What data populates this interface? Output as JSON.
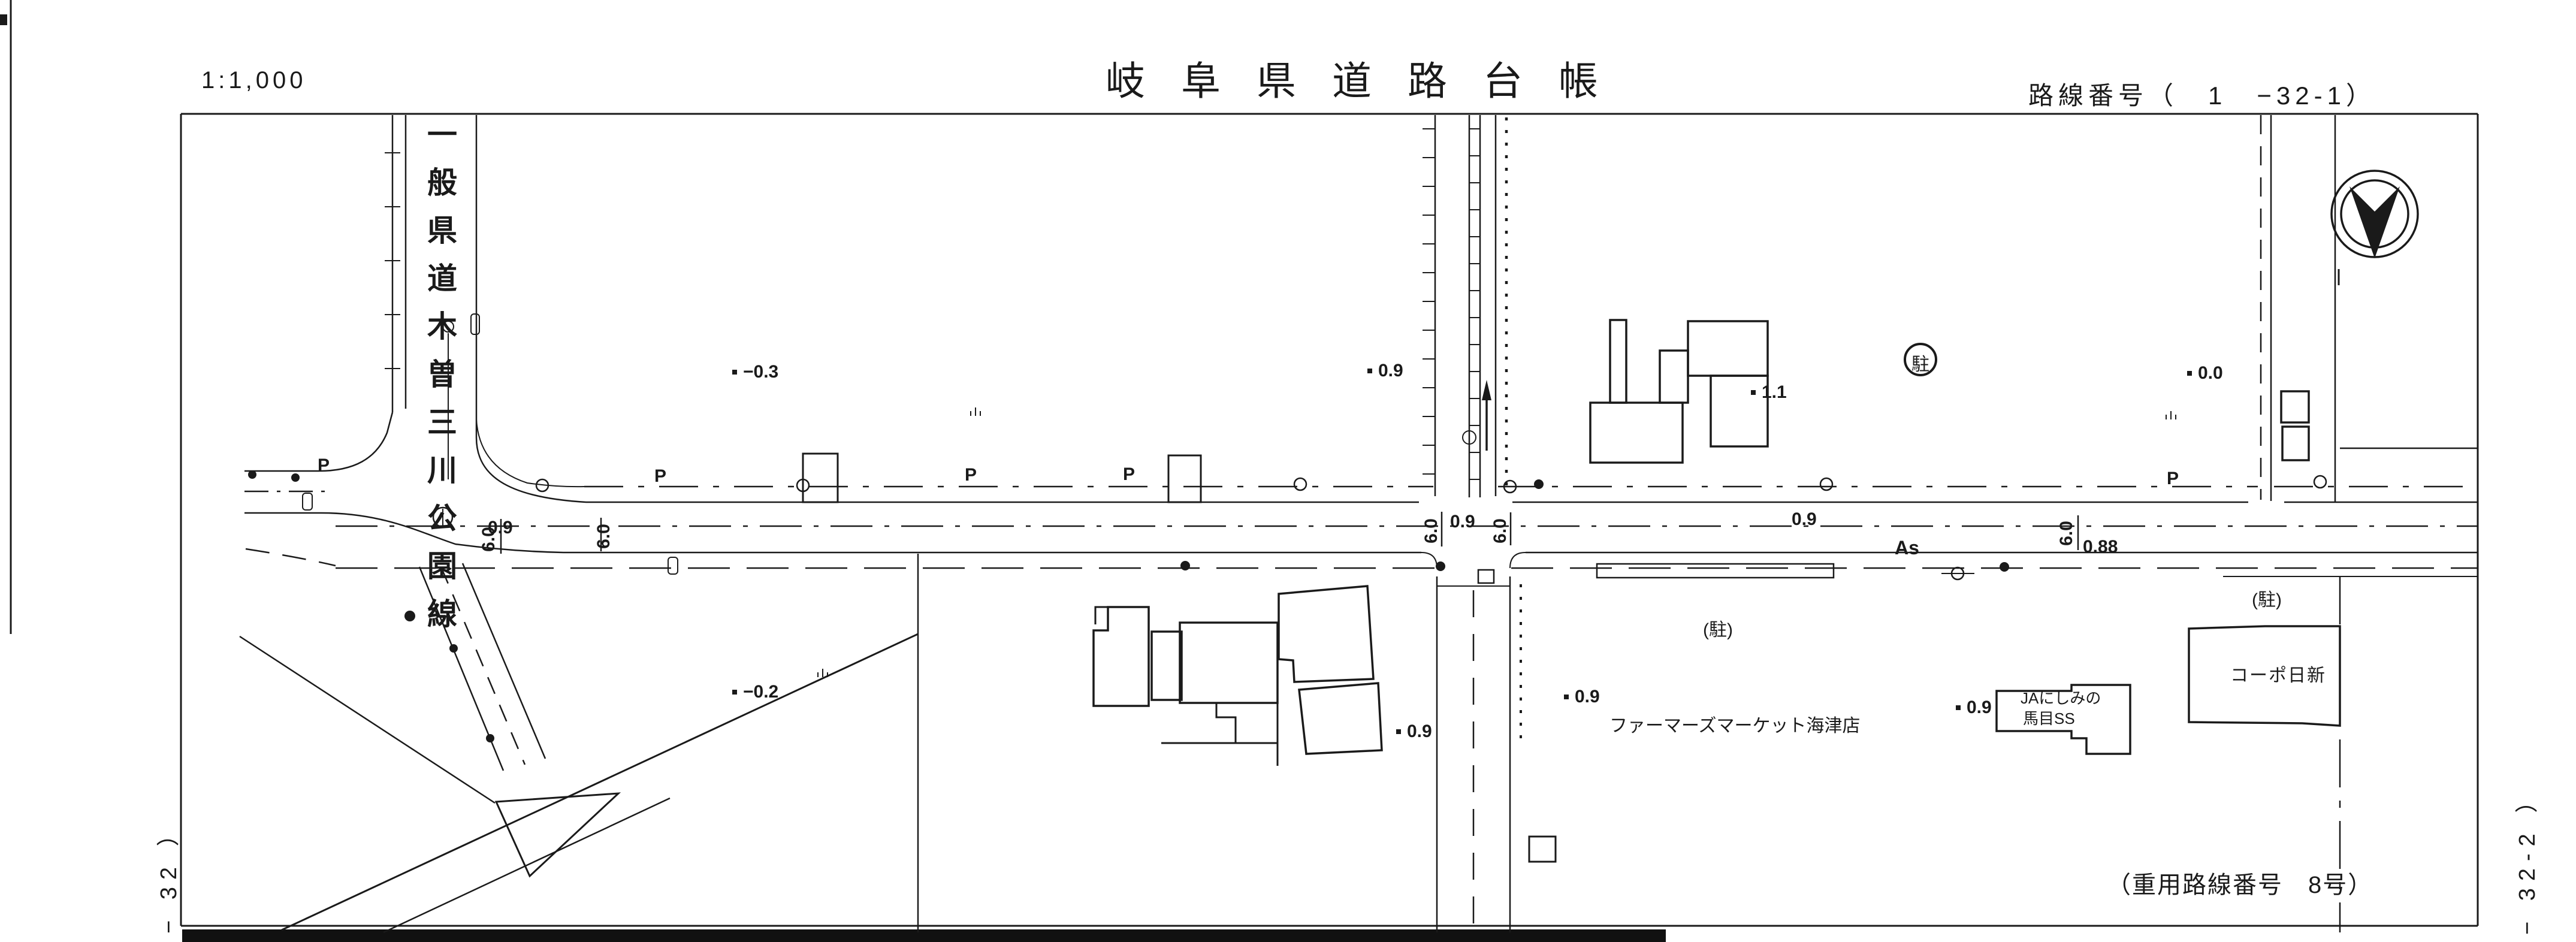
{
  "header": {
    "scale_label": "1:1,000",
    "title": "岐阜県道路台帳",
    "route_number": "路線番号（　1　−32-1）"
  },
  "sheet": {
    "ref_left": "− 32 ）",
    "ref_right": "− 32-2 ）",
    "overlap_note": "（重用路線番号　8号）"
  },
  "road": {
    "name_vertical": "一般県道木曽三川公園線",
    "surface": "As"
  },
  "buildings": {
    "farmers_market": "ファーマーズマーケット海津店",
    "ja_line1": "JAにしみの",
    "ja_line2": "馬目SS",
    "corpo_nisshin": "コーポ日新"
  },
  "annotations": {
    "spot_elevations": [
      {
        "value": "−0.3"
      },
      {
        "value": "0.9"
      },
      {
        "value": "1.1"
      },
      {
        "value": "0.0"
      },
      {
        "value": "−0.2"
      },
      {
        "value": "0.9"
      },
      {
        "value": "0.9"
      },
      {
        "value": "0.9"
      }
    ],
    "road_widths": [
      {
        "value": "6.0"
      },
      {
        "value": "6.0"
      },
      {
        "value": "6.0"
      },
      {
        "value": "6.0"
      },
      {
        "value": "6.0"
      }
    ],
    "road_measures": [
      {
        "value": "0.9"
      },
      {
        "value": "0.9"
      },
      {
        "value": "0.9"
      },
      {
        "value": "0.88"
      }
    ],
    "pole_label": "P",
    "parking_label": "(駐)",
    "parking_circled": "駐"
  },
  "icons": {
    "north_arrow": "circled-v-north-arrow",
    "grass_mark": "ılı"
  },
  "colors": {
    "ink": "#1a1a1a",
    "paper": "#ffffff"
  }
}
